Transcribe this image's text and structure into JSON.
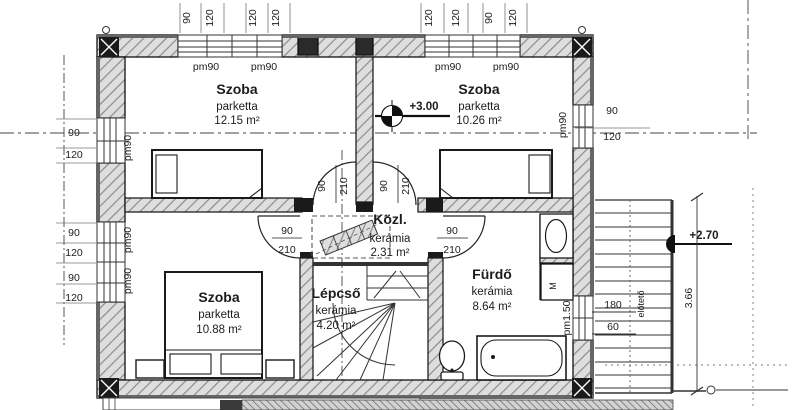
{
  "rooms": {
    "szoba_tl": {
      "name": "Szoba",
      "floor": "parketta",
      "area": "12.15 m²"
    },
    "szoba_tr": {
      "name": "Szoba",
      "floor": "parketta",
      "area": "10.26 m²"
    },
    "szoba_bl": {
      "name": "Szoba",
      "floor": "parketta",
      "area": "10.88 m²"
    },
    "kozl": {
      "name": "Közl.",
      "floor": "kerámia",
      "area": "2.31 m²"
    },
    "lepcso": {
      "name": "Lépcső",
      "floor": "kerámia",
      "area": "4.20 m²"
    },
    "furdo": {
      "name": "Fürdő",
      "floor": "kerámia",
      "area": "8.64 m²"
    }
  },
  "levels": {
    "floor": "+3.00",
    "landing": "+2.70"
  },
  "door": {
    "width": "90",
    "height": "210"
  },
  "labels": {
    "pm90": "pm90",
    "pm150": "pm1.50",
    "washer": "M",
    "canopy": "előtető"
  },
  "dims": {
    "top_left": [
      "90",
      "120",
      "120",
      "120"
    ],
    "top_right": [
      "120",
      "120",
      "90",
      "120"
    ],
    "left": [
      "90",
      "120",
      "90",
      "120",
      "90",
      "120"
    ],
    "right": [
      "90",
      "120"
    ],
    "stair_side": [
      "180",
      "60"
    ],
    "stair_height": "3.66"
  }
}
